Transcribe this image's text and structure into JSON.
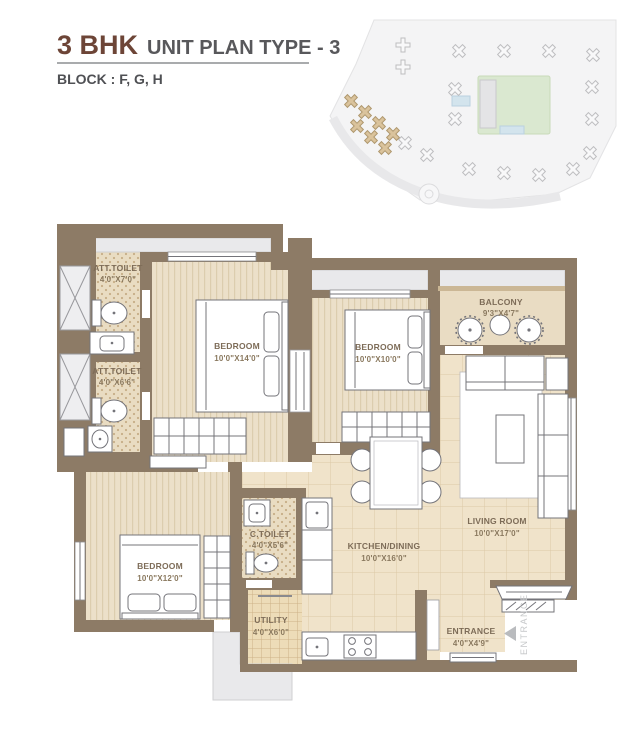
{
  "header": {
    "title_main": "3 BHK",
    "title_rest": "UNIT PLAN TYPE - 3",
    "block": "BLOCK : F, G, H"
  },
  "colors": {
    "title_brown": "#6d4537",
    "title_gray": "#58585b",
    "wall": "#8d7b66",
    "floor_tile": "#f0e3ca",
    "floor_stripe": "#ece0c9",
    "toilet_dot_floor": "#e9dcc2",
    "utility_floor": "#eddcb8",
    "balcony_floor": "#e9dcc3",
    "site_highlight": "#d6bd92",
    "label_text": "#7d6c58"
  },
  "rooms": [
    {
      "name": "ATT.TOILET",
      "dims": "4'0\"X7'0\""
    },
    {
      "name": "BEDROOM",
      "dims": "10'0\"X14'0\""
    },
    {
      "name": "ATT.TOILET",
      "dims": "4'0\"X6'6\""
    },
    {
      "name": "BEDROOM",
      "dims": "10'0\"X10'0\""
    },
    {
      "name": "BALCONY",
      "dims": "9'3\"X4'7\""
    },
    {
      "name": "LIVING ROOM",
      "dims": "10'0\"X17'0\""
    },
    {
      "name": "BEDROOM",
      "dims": "10'0\"X12'0\""
    },
    {
      "name": "C.TOILET",
      "dims": "4'0\"X5'6\""
    },
    {
      "name": "KITCHEN/DINING",
      "dims": "10'0\"X16'0\""
    },
    {
      "name": "UTILITY",
      "dims": "4'0\"X6'0\""
    },
    {
      "name": "ENTRANCE",
      "dims": "4'0\"X4'9\""
    }
  ],
  "entrance_side_label": "ENTRANCE"
}
